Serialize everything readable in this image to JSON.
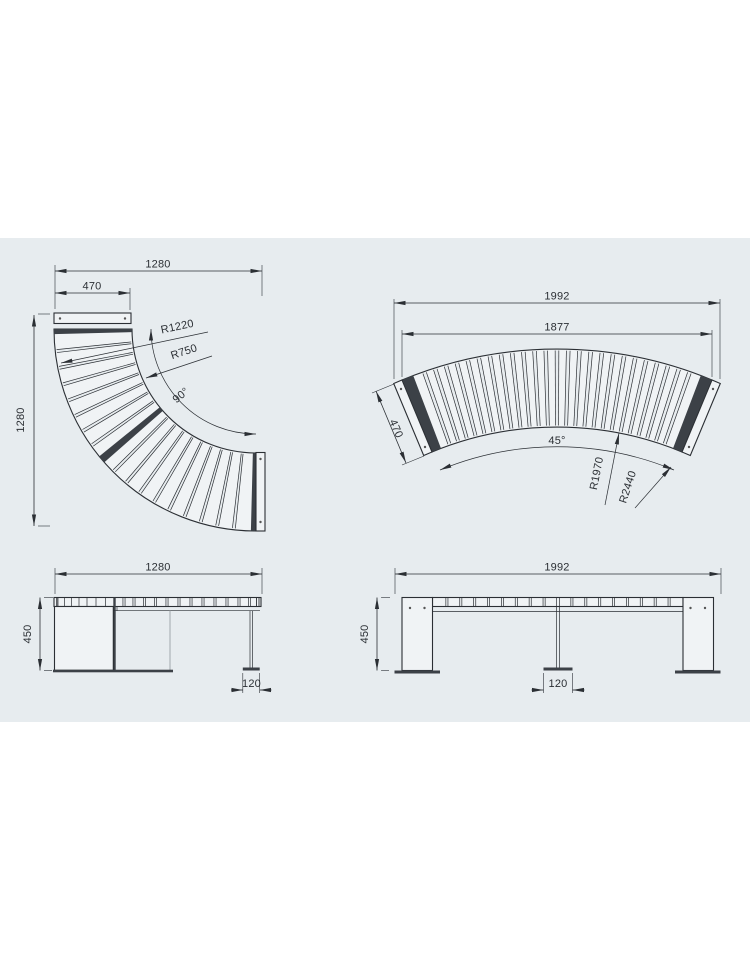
{
  "theme": {
    "page_bg": "#ffffff",
    "panel_bg": "#e7ecef",
    "line": "#2b2f34",
    "dark": "#3c4147",
    "gray_line": "#8f969c",
    "hatch": "#cdd3d7",
    "light_fill": "#f0f3f5"
  },
  "views": {
    "plan_90": {
      "dims": {
        "overall_width": "1280",
        "seat_depth": "470",
        "overall_depth": "1280",
        "radius_outer": "R1220",
        "radius_inner": "R750",
        "arc_angle": "90°"
      }
    },
    "plan_45": {
      "dims": {
        "overall_width": "1992",
        "outer_chord": "1877",
        "seat_depth": "470",
        "arc_angle": "45°",
        "radius_inner": "R1970",
        "radius_outer": "R2440"
      }
    },
    "front_90": {
      "dims": {
        "width": "1280",
        "height": "450",
        "foot": "120"
      }
    },
    "front_45": {
      "dims": {
        "width": "1992",
        "height": "450",
        "foot": "120"
      }
    }
  }
}
